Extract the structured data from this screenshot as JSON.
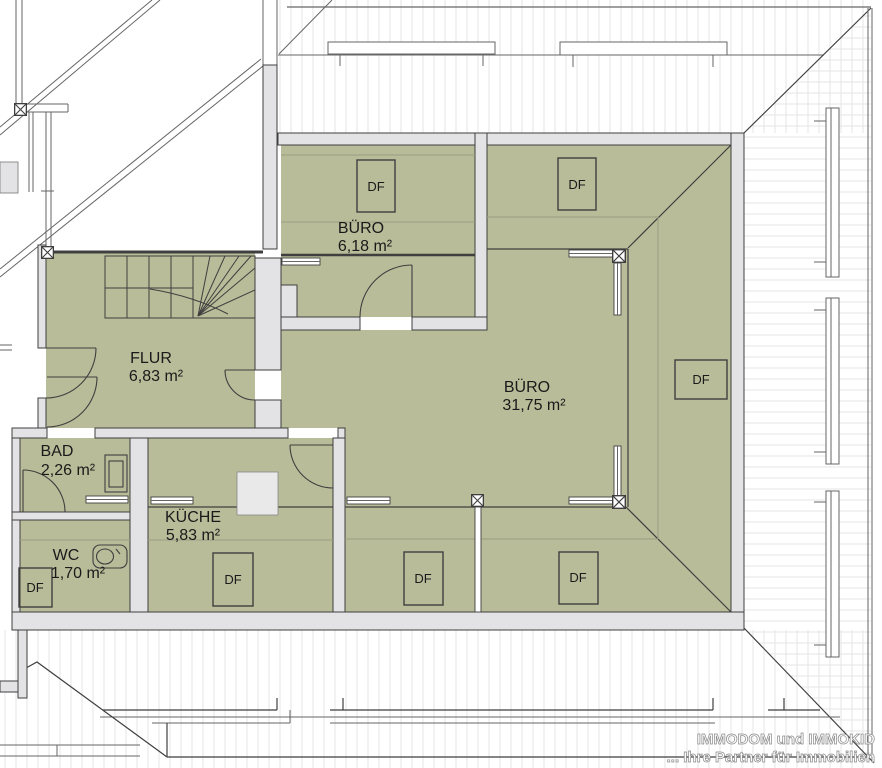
{
  "plan": {
    "rooms": [
      {
        "id": "buero-klein",
        "name": "BÜRO",
        "area": "6,18 m²"
      },
      {
        "id": "buero-gross",
        "name": "BÜRO",
        "area": "31,75 m²"
      },
      {
        "id": "flur",
        "name": "FLUR",
        "area": "6,83 m²"
      },
      {
        "id": "bad",
        "name": "BAD",
        "area": "2,26 m²"
      },
      {
        "id": "wc",
        "name": "WC",
        "area": "1,70 m²"
      },
      {
        "id": "kueche",
        "name": "KÜCHE",
        "area": "5,83 m²"
      }
    ],
    "labels": {
      "df": "DF"
    },
    "watermark": {
      "line1": "IMMODOM und IMMOKID",
      "line2": "... Ihre Partner für Immobilien"
    },
    "colors": {
      "room_fill": "#b9bc99",
      "wall_fill": "#e3e3e5",
      "wall_line": "#3f3f3f",
      "faint_line": "#9a9d84",
      "hatch": "#e5e5e5",
      "outside_line": "#666666",
      "text": "#1a1a1a",
      "watermark": "#8a8a8a",
      "chimney": "#e9e9e9"
    }
  }
}
